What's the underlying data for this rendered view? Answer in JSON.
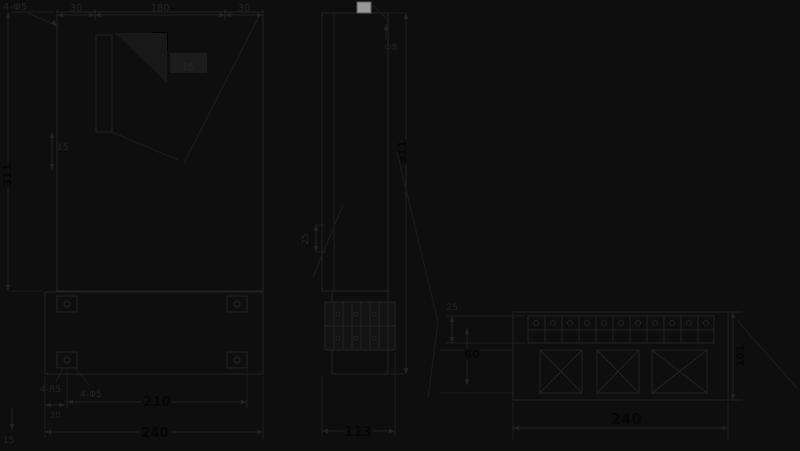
{
  "drawing": {
    "type": "technical-dimension-drawing",
    "colors": {
      "background": "#0e0e0e",
      "line": "#232323",
      "bold_dimension_text": "#060606",
      "knob_highlight": "#999999"
    },
    "front_view": {
      "corner_label": "4-Φ5",
      "top_dims": [
        "30",
        "180",
        "30"
      ],
      "inner_label": "15",
      "height_label": "311",
      "slot_dim": "15"
    },
    "back_view": {
      "fillet_label": "4-R5",
      "hole_label": "4-Φ5",
      "edge_dim": "30",
      "foot_dim": "15",
      "hole_pitch": "210",
      "overall_width": "240"
    },
    "side_view": {
      "knob_label": "Φ8",
      "depth_dim": "25",
      "height_label": "311",
      "lower_width": "113"
    },
    "bottom_view": {
      "strip_dim": "25",
      "block_dim": "60",
      "depth_label": "101",
      "overall_width": "240"
    }
  }
}
